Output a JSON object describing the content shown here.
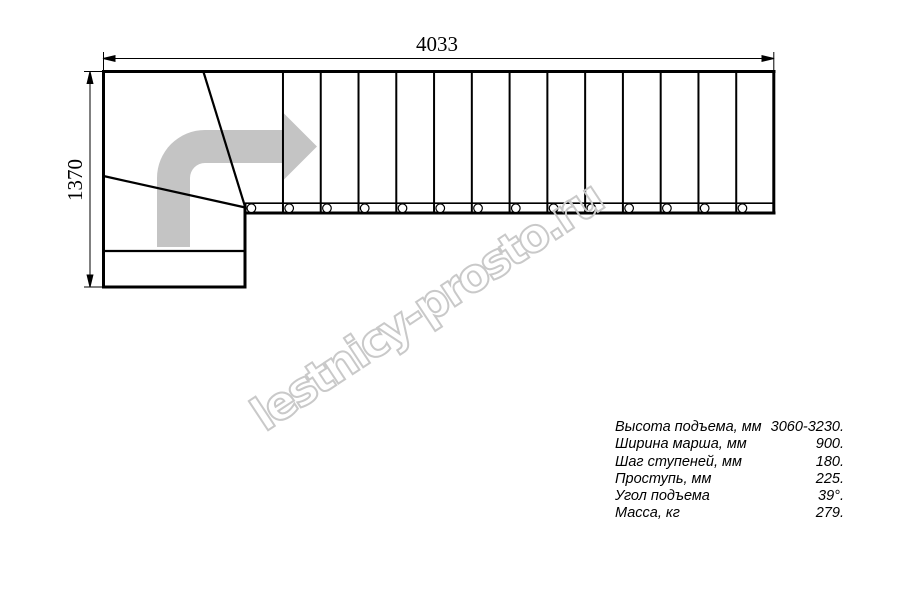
{
  "drawing": {
    "dimensions": {
      "width_label": "4033",
      "height_label": "1370"
    },
    "plan": {
      "straight_steps": 14,
      "winder_steps": 3,
      "step_markers": 14
    },
    "arrow_color": "#c4c4c4",
    "watermark": {
      "text": "lestnicy-prosto.ru",
      "color": "#c9c9c9"
    },
    "line_color": "#000000"
  },
  "specs": {
    "rows": [
      {
        "label": "Высота подъема, мм",
        "value": "3060-3230."
      },
      {
        "label": "Ширина марша, мм",
        "value": "900."
      },
      {
        "label": "Шаг ступеней, мм",
        "value": "180."
      },
      {
        "label": "Проступь, мм",
        "value": "225."
      },
      {
        "label": "Угол подъема",
        "value": "39°."
      },
      {
        "label": "Масса, кг",
        "value": "279."
      }
    ]
  }
}
